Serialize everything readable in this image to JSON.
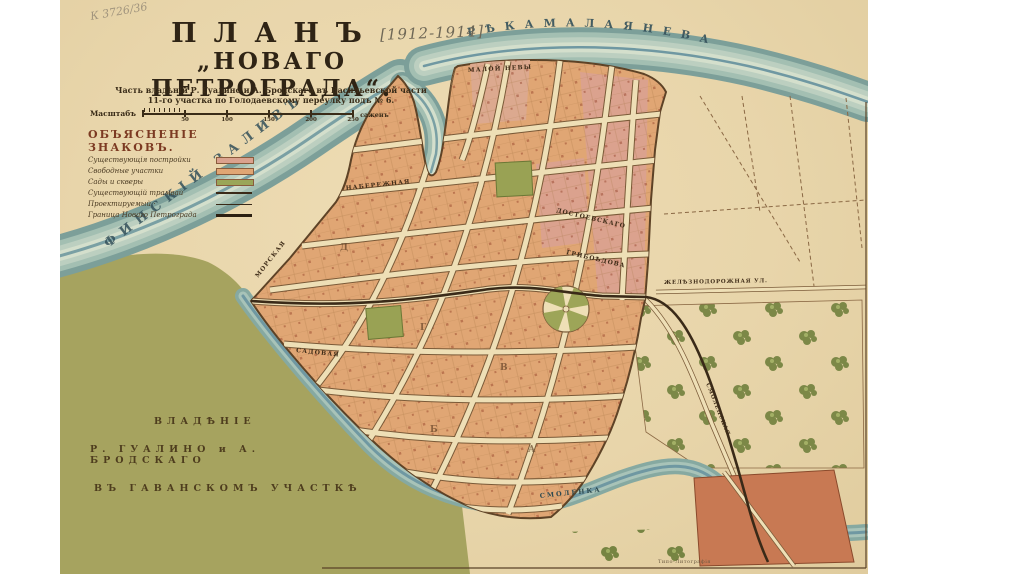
{
  "sheet": {
    "pencil_note": "К 3726/36",
    "title": {
      "line1": "ПЛАНЪ",
      "annotation": "[1912-1914]",
      "line2": "„НОВАГО ПЕТРОГРАДА“.",
      "subtitle1": "Часть владѣній Р. Гуалино и А. Бродскаго въ Васильевской части",
      "subtitle2": "11-го участка по Голодаевскому переулку подъ № 6."
    },
    "scale": {
      "label": "Масштабъ",
      "ticks": [
        "50",
        "100",
        "150",
        "200",
        "250"
      ],
      "units": "саженъ"
    },
    "legend": {
      "title": "ОБЪЯСНЕНІЕ ЗНАКОВЪ.",
      "items": [
        {
          "label": "Существующія постройки",
          "type": "swatch-pink"
        },
        {
          "label": "Свободные участки",
          "type": "swatch-tan"
        },
        {
          "label": "Сады и скверы",
          "type": "swatch-green"
        },
        {
          "label": "Существующій трамвай",
          "type": "line-solid"
        },
        {
          "label": "Проектируемый  ·",
          "type": "line-thin"
        },
        {
          "label": "Граница Новаго Петрограда",
          "type": "line-thick"
        }
      ]
    },
    "water_labels": {
      "neva": "Р Ѣ К А   М А Л А Я   Н Е В А",
      "gulf": "ФИНСКІЙ  ЗАЛИВЪ",
      "smolenka": "СМОЛЕНКА"
    },
    "ownership": {
      "line1": "ВЛАДѢНІЕ",
      "line2": "Р. ГУАЛИНО  и  А. БРОДСКАГО",
      "line3": "ВЪ ГАВАНСКОМЪ  УЧАСТКѢ"
    },
    "streets": {
      "nab_maloy_nevy": "МАЛОЙ  НЕВЫ",
      "naberezhnaya": "НАБЕРЕЖНАЯ",
      "morskaya": "МОРСКАЯ",
      "sadovaya": "САДОВАЯ",
      "dostoevskago": "ДОСТОЕВСКАГО",
      "griboedova": "ГРИБОѢДОВА",
      "zheleznodorozhnaya": "ЖЕЛѢЗНОДОРОЖНАЯ УЛ.",
      "smolenskaya": "СМОЛЕНСКАЯ"
    },
    "block_letters": {
      "b1": "А",
      "b2": "Б",
      "b3": "В",
      "b4": "Г",
      "b5": "Д"
    },
    "imprint": "Типо-Литографія",
    "colors": {
      "paper": "#e9d7ae",
      "water_band": "#8aaca3",
      "water_center": "#6f98a2",
      "land_olive": "#a6a35f",
      "blocks_free": "#e0a674",
      "blocks_built": "#dba28e",
      "block_red": "#c87953",
      "parks_green": "#99a254",
      "line_brown": "#7a5a38",
      "ink_dark": "#2f2415"
    }
  }
}
